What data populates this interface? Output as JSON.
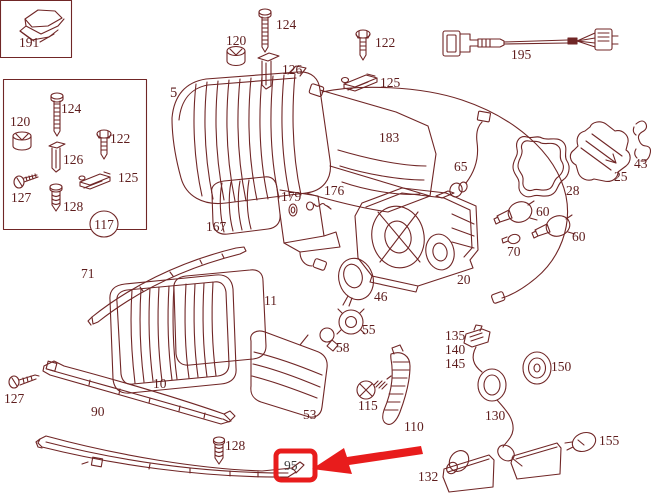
{
  "diagram": {
    "description": "Headlamp assembly exploded parts diagram",
    "highlighted_part": "95"
  },
  "colors": {
    "line": "#702626",
    "label": "#5e1d1d",
    "highlight": "#e81c1c",
    "background": "#ffffff"
  },
  "parts": {
    "p191": "191",
    "box124": "124",
    "box120": "120",
    "box122": "122",
    "box126": "126",
    "box125": "125",
    "box127": "127",
    "box128": "128",
    "box117": "117",
    "p5": "5",
    "p120": "120",
    "p124": "124",
    "p126": "126",
    "p122": "122",
    "p125": "125",
    "p195": "195",
    "p183": "183",
    "p65": "65",
    "p28": "28",
    "p25": "25",
    "p43": "43",
    "p167": "167",
    "p179": "179",
    "p176": "176",
    "p20": "20",
    "p60a": "60",
    "p60b": "60",
    "p70": "70",
    "p46": "46",
    "p55": "55",
    "p58": "58",
    "p71": "71",
    "p11": "11",
    "p10": "10",
    "p90": "90",
    "p127b": "127",
    "p53": "53",
    "p115": "115",
    "p110": "110",
    "p128b": "128",
    "p95": "95",
    "p135": "135",
    "p140": "140",
    "p145": "145",
    "p150": "150",
    "p130": "130",
    "p155": "155",
    "p132": "132"
  }
}
